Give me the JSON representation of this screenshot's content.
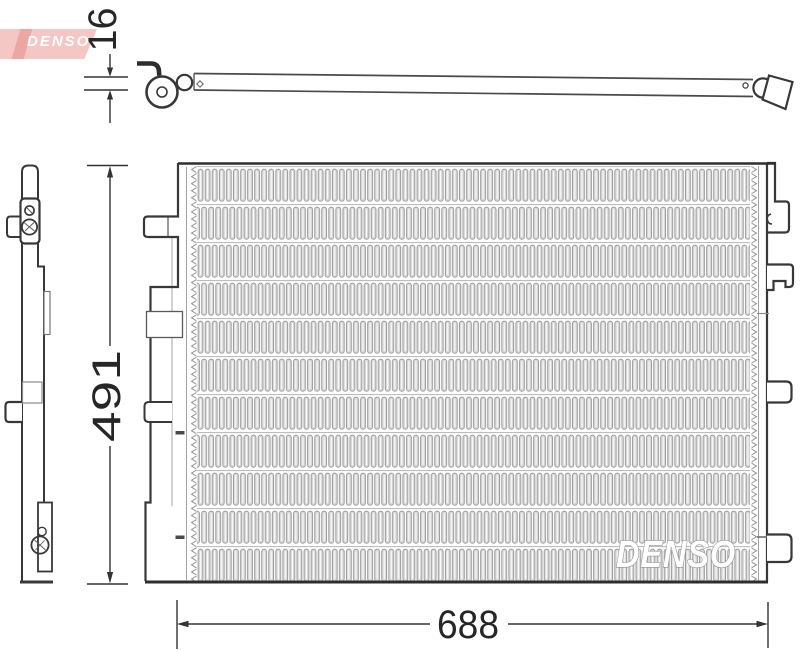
{
  "page": {
    "background": "#ffffff",
    "line_color": "#383838",
    "fin_color": "#9b9b9b"
  },
  "brand": {
    "logo_text": "DENSO",
    "logo_bg": "#f4c7c4",
    "logo_accent": "#eba7a2",
    "logo_text_color": "#ffffff",
    "watermark_text": "DENSO"
  },
  "drawing": {
    "type": "technical-drawing",
    "dimensions": [
      {
        "name": "thickness",
        "value": "16",
        "unit_hint": "mm"
      },
      {
        "name": "height",
        "value": "491",
        "unit_hint": "mm"
      },
      {
        "name": "width",
        "value": "688",
        "unit_hint": "mm"
      }
    ]
  }
}
